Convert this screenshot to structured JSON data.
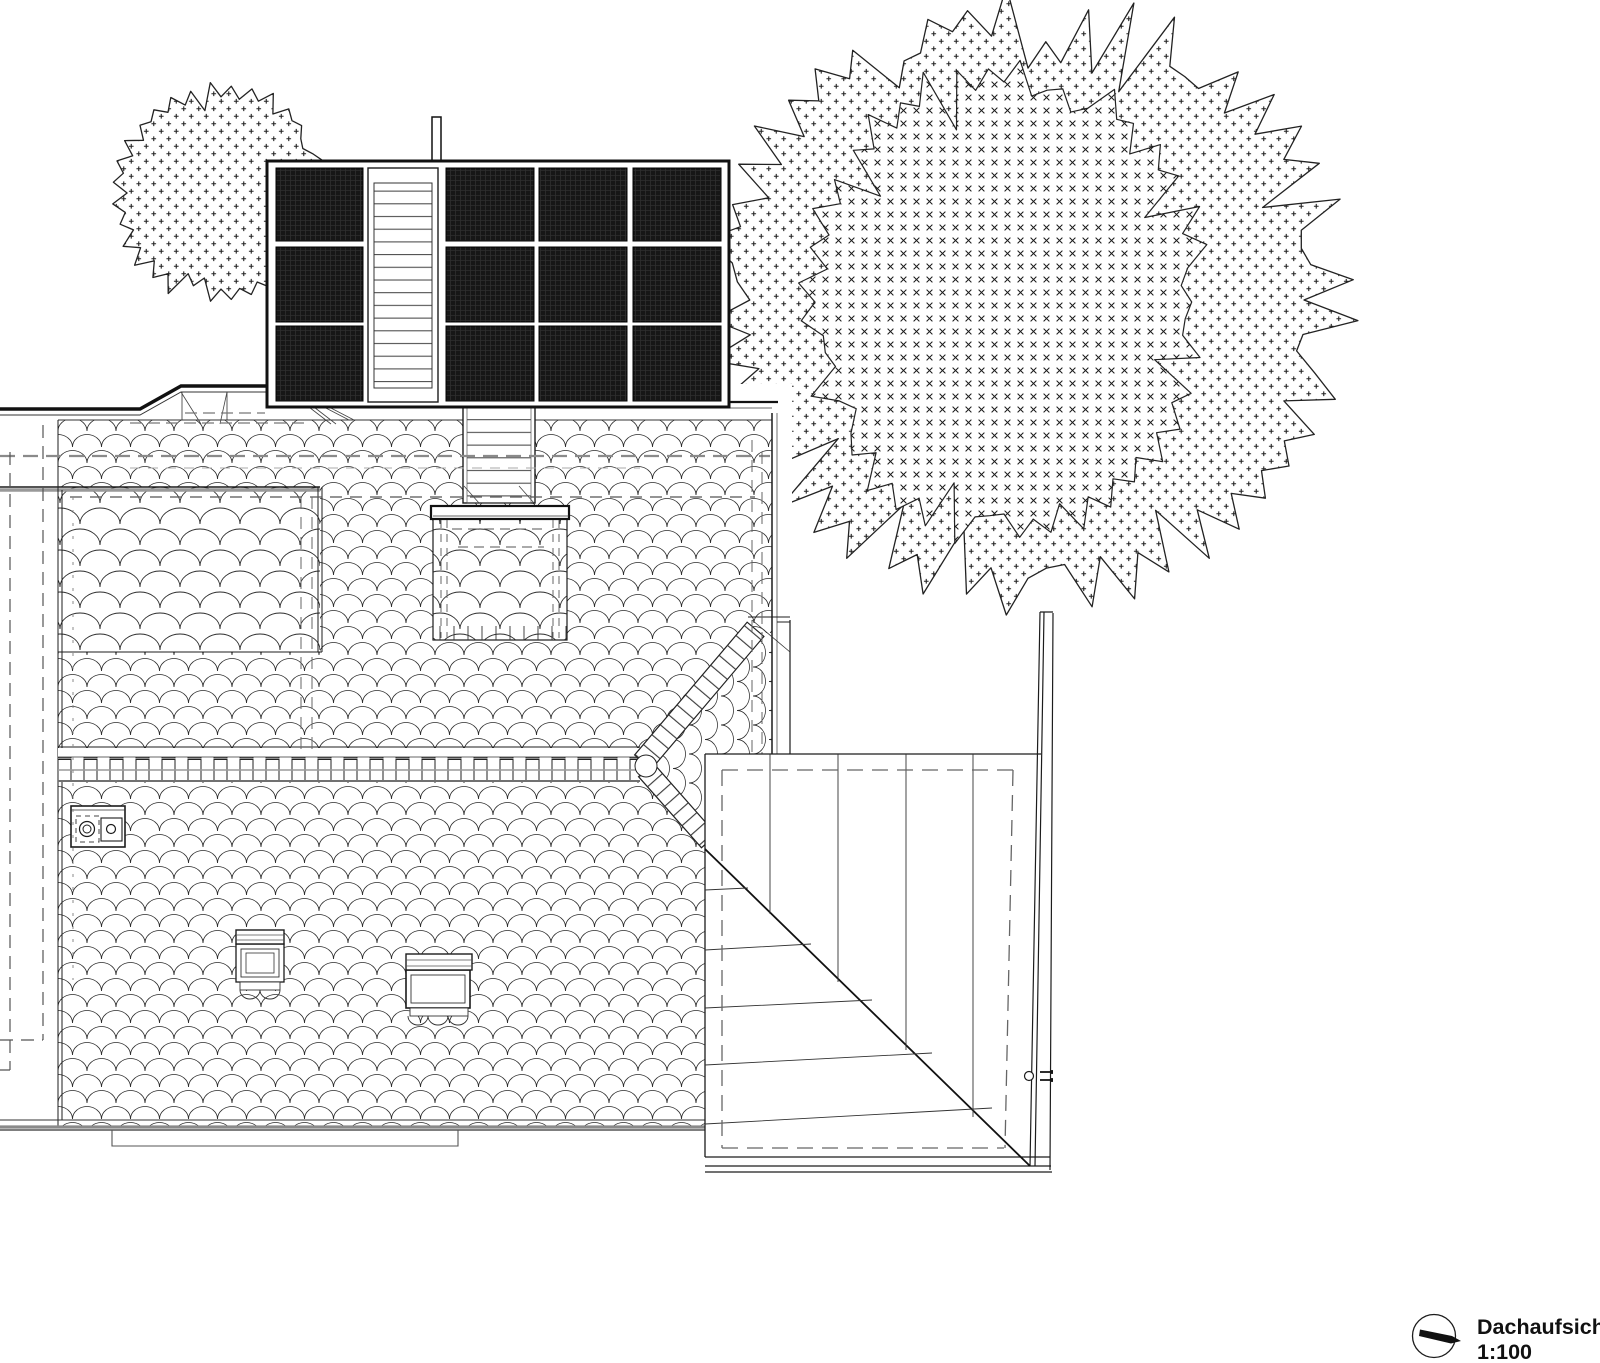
{
  "document": {
    "type": "architectural-drawing",
    "view": "roof-plan-top-view"
  },
  "title_block": {
    "title": "Dachaufsicht",
    "scale_label": "1:100",
    "symbol": "north-orientation-circle-with-needle"
  },
  "colors": {
    "background": "#ffffff",
    "line": "#1c1c1c",
    "line_grey": "#8a8a8a",
    "dashed_hidden": "#666666",
    "solar_panel_fill": "#161616",
    "solar_panel_grid": "#2e2e2e"
  },
  "roof_plan": {
    "solar_array": {
      "panel_rows": 3,
      "panel_columns": 4,
      "panel_count": 12,
      "walkway_columns": 2
    },
    "skylight_count": 2,
    "chimney_flues": 2,
    "tree_canopies": 3,
    "hatch_patterns": {
      "main_roof": "fish-scale-tiles",
      "dormer_and_lower_roof": "large-fish-scale-tiles",
      "outer_tree": "plus-symbols",
      "inner_tree": "cross-symbols"
    }
  }
}
